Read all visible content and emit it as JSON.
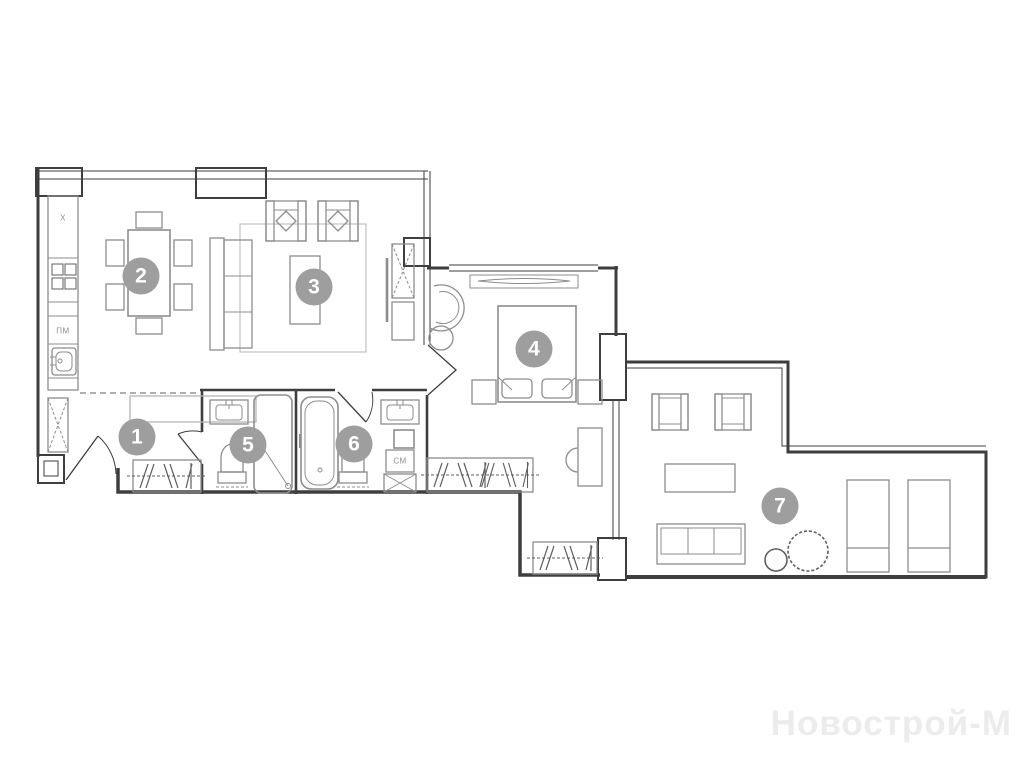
{
  "watermark": {
    "text": "Новострой-М"
  },
  "plan": {
    "room_markers": [
      {
        "number": "1",
        "x": 137,
        "y": 437
      },
      {
        "number": "2",
        "x": 141,
        "y": 276
      },
      {
        "number": "3",
        "x": 314,
        "y": 287
      },
      {
        "number": "4",
        "x": 534,
        "y": 349
      },
      {
        "number": "5",
        "x": 248,
        "y": 445
      },
      {
        "number": "6",
        "x": 354,
        "y": 444
      },
      {
        "number": "7",
        "x": 780,
        "y": 506
      }
    ],
    "appliance_labels": [
      {
        "id": "fridge-label",
        "text": "Х",
        "x": 63,
        "y": 218
      },
      {
        "id": "dishwasher-label",
        "text": "ПМ",
        "x": 63,
        "y": 331
      },
      {
        "id": "washer-label",
        "text": "СМ",
        "x": 400,
        "y": 461
      }
    ],
    "colors": {
      "background": "#ffffff",
      "wall": "#3e3e3e",
      "furn": "#8d8d8d",
      "furnlight": "#b5b5b5",
      "hatch": "#5f5f5f",
      "marker": "#9e9e9e",
      "markertext": "#ffffff",
      "watermark": "#ececec"
    }
  }
}
